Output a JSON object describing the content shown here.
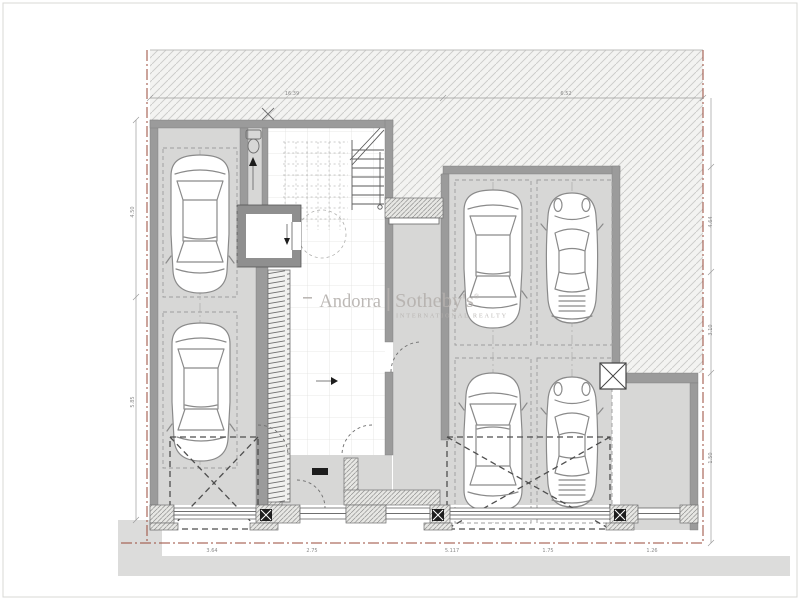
{
  "watermark": {
    "brand": "Andorra",
    "name": "Sotheby's",
    "registered": "®",
    "tagline": "INTERNATIONAL REALTY"
  },
  "colors": {
    "wall": "#9b9b9b",
    "floor": "#d7d7d6",
    "site-bg": "#f3f3f1",
    "site-line": "#cacac8",
    "prop": "#9a4a3a",
    "street": "#dcdcdb",
    "car": "#8a8a8a",
    "wm": "#b5b1ae",
    "dim": "#9a9a9a"
  },
  "plan": {
    "type": "architectural-floor-plan-garage-level",
    "cars": [
      {
        "id": "car-1",
        "type": "sedan",
        "x": 200,
        "y": 224,
        "rotation": 180
      },
      {
        "id": "car-2",
        "type": "sedan",
        "x": 201,
        "y": 392,
        "rotation": 180
      },
      {
        "id": "car-3",
        "type": "sedan",
        "x": 493,
        "y": 259,
        "rotation": 180
      },
      {
        "id": "car-4",
        "type": "sports",
        "x": 572,
        "y": 258,
        "rotation": 0
      },
      {
        "id": "car-5",
        "type": "sedan",
        "x": 493,
        "y": 442,
        "rotation": 0
      },
      {
        "id": "car-6",
        "type": "sports",
        "x": 572,
        "y": 442,
        "rotation": 0
      }
    ]
  },
  "dimensions": {
    "top": [
      {
        "text": "16.39",
        "x": 292,
        "y": 95
      },
      {
        "text": "6.52",
        "x": 566,
        "y": 95
      }
    ],
    "bottom": [
      {
        "text": "3.64",
        "x": 212,
        "y": 552
      },
      {
        "text": "2.75",
        "x": 312,
        "y": 552
      },
      {
        "text": "5.117",
        "x": 452,
        "y": 552
      },
      {
        "text": "1.75",
        "x": 548,
        "y": 552
      },
      {
        "text": "1.26",
        "x": 652,
        "y": 552
      }
    ],
    "left": [
      {
        "text": "4.50",
        "x": 134,
        "y": 212,
        "rot": -90
      },
      {
        "text": "5.85",
        "x": 134,
        "y": 402,
        "rot": -90
      }
    ],
    "right": [
      {
        "text": "4.64",
        "x": 712,
        "y": 222,
        "rot": -90
      },
      {
        "text": "3.10",
        "x": 712,
        "y": 330,
        "rot": -90
      },
      {
        "text": "1.50",
        "x": 712,
        "y": 458,
        "rot": -90
      }
    ]
  }
}
